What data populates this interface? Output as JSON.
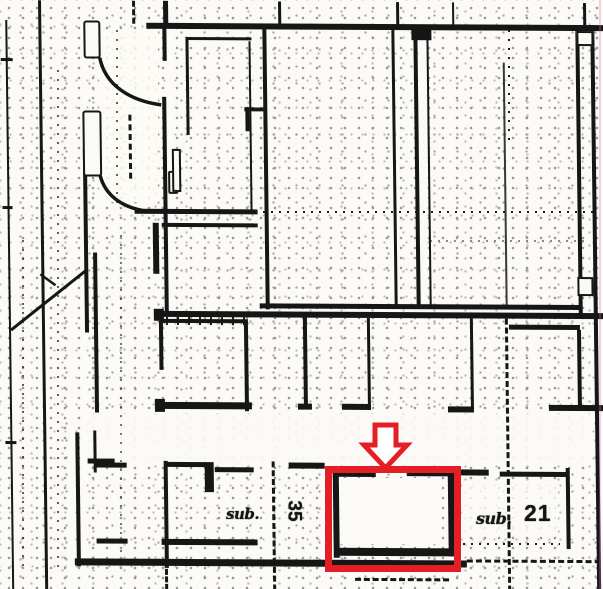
{
  "plan": {
    "kind": "scanned floor plan",
    "labels": {
      "unit_left": {
        "prefix": "sub.",
        "number": "35"
      },
      "unit_right": {
        "prefix": "sub.",
        "number": "21"
      }
    }
  },
  "annotation": {
    "arrow_icon": "down-arrow",
    "highlight_color": "#e31e24"
  },
  "colors": {
    "paper": "#fbfaf6",
    "ink": "#161616",
    "highlight": "#e31e24"
  }
}
